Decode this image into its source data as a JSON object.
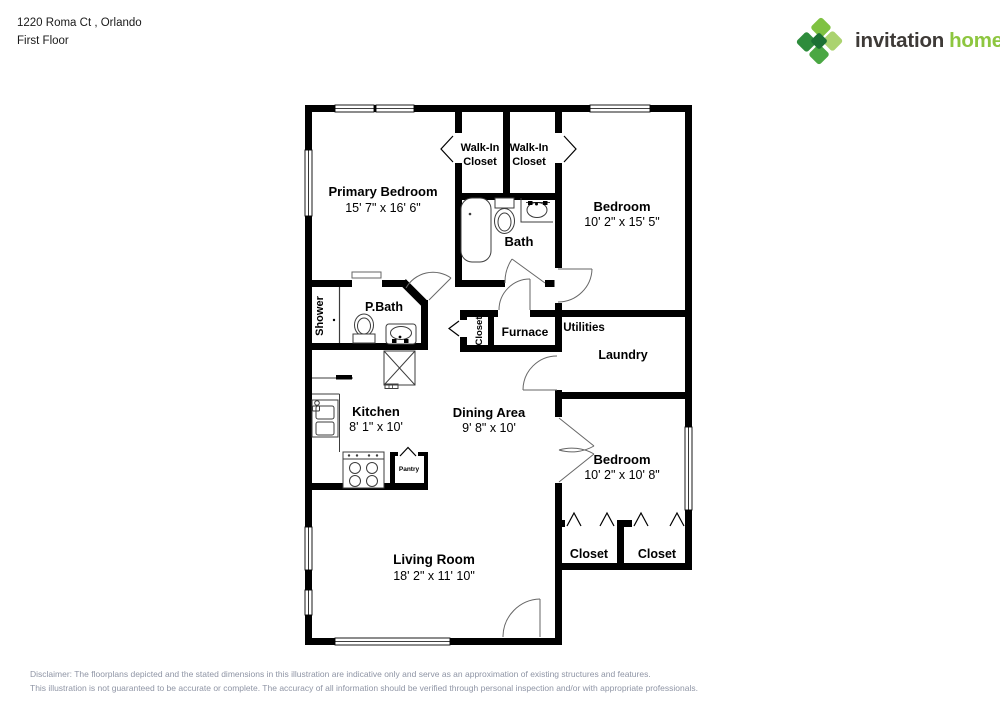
{
  "header": {
    "address": "1220 Roma Ct , Orlando",
    "floor_label": "First Floor"
  },
  "logo": {
    "word1": "invitation",
    "word2": "homes",
    "trademark": "™",
    "word1_color": "#3e3a37",
    "word2_color": "#8dc63f",
    "icon_colors": {
      "north": "#7fc242",
      "east": "#abd36f",
      "south": "#4aa743",
      "west": "#2e8c3c",
      "center": "#1c7134"
    }
  },
  "plan": {
    "rooms": {
      "primary_bedroom": {
        "label": "Primary Bedroom",
        "dims": "15' 7\" x 16' 6\""
      },
      "walk_in_closet_left": {
        "line1": "Walk-In",
        "line2": "Closet"
      },
      "walk_in_closet_right": {
        "line1": "Walk-In",
        "line2": "Closet"
      },
      "bedroom_upper_right": {
        "label": "Bedroom",
        "dims": "10' 2\" x 15' 5\""
      },
      "bath": {
        "label": "Bath"
      },
      "shower": {
        "label": "Shower"
      },
      "primary_bath": {
        "label": "P.Bath"
      },
      "hall_closet": {
        "label": "Closet"
      },
      "furnace": {
        "label": "Furnace"
      },
      "utilities": {
        "label": "Utilities"
      },
      "laundry": {
        "label": "Laundry"
      },
      "kitchen": {
        "label": "Kitchen",
        "dims": "8' 1\" x 10'"
      },
      "dining_area": {
        "label": "Dining Area",
        "dims": "9' 8\" x 10'"
      },
      "pantry": {
        "label": "Pantry"
      },
      "bedroom_lower_right": {
        "label": "Bedroom",
        "dims": "10' 2\" x 10' 8\""
      },
      "closet_bottom_left": {
        "label": "Closet"
      },
      "closet_bottom_right": {
        "label": "Closet"
      },
      "living_room": {
        "label": "Living Room",
        "dims": "18' 2\" x 11' 10\""
      }
    }
  },
  "footer": {
    "line1": "Disclaimer: The floorplans depicted and the stated dimensions in this illustration are indicative only and serve as an approximation of existing structures and features.",
    "line2": "This illustration is not guaranteed to be accurate or complete. The accuracy of all information should be verified through personal inspection and/or with appropriate professionals."
  }
}
